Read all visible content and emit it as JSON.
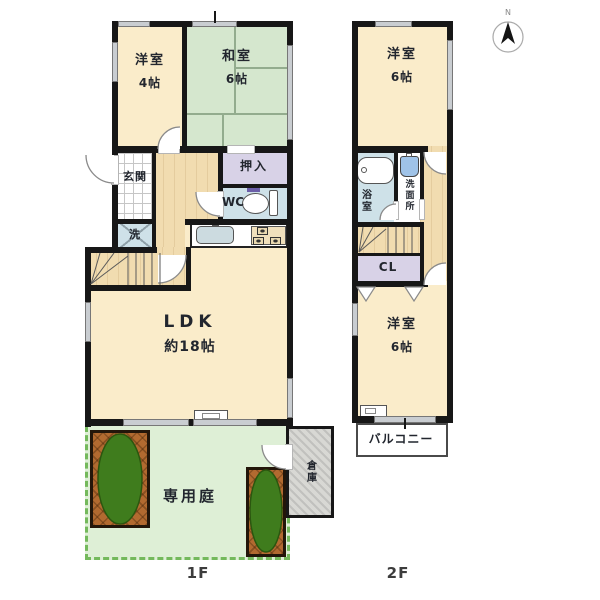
{
  "floor1": {
    "label": "1F",
    "rooms": {
      "western": {
        "name": "洋室",
        "size": "4帖"
      },
      "japanese": {
        "name": "和室",
        "size": "6帖"
      },
      "entrance": {
        "name": "玄関"
      },
      "closet": {
        "name": "押入"
      },
      "toilet": {
        "name": "WC"
      },
      "laundry": {
        "name": "洗"
      },
      "ldk": {
        "name": "LDK",
        "size": "約18帖"
      },
      "garden": {
        "name": "専用庭"
      },
      "storage": {
        "name": "倉庫"
      }
    }
  },
  "floor2": {
    "label": "2F",
    "rooms": {
      "western_north": {
        "name": "洋室",
        "size": "6帖"
      },
      "bathroom": {
        "name": "浴室"
      },
      "washroom": {
        "name": "洗面所"
      },
      "closet": {
        "name": "CL"
      },
      "western_south": {
        "name": "洋室",
        "size": "6帖"
      },
      "balcony": {
        "name": "バルコニー"
      }
    }
  },
  "compass": {
    "north": "N"
  },
  "colors": {
    "wall": "#171717",
    "room_cream": "#faecca",
    "tatami_green": "#d5e7ce",
    "wood": "#f1dcb0",
    "closet_purple": "#d8d2e7",
    "wet_blue": "#cee1e8",
    "garden_green": "#deefd6",
    "garden_border": "#74b95c",
    "planter_brown": "#b26a30",
    "tree_green": "#3f7c1d",
    "storage_gray": "#d8d8d4",
    "window_gray": "#c9cdd1",
    "text": "#22262e"
  }
}
